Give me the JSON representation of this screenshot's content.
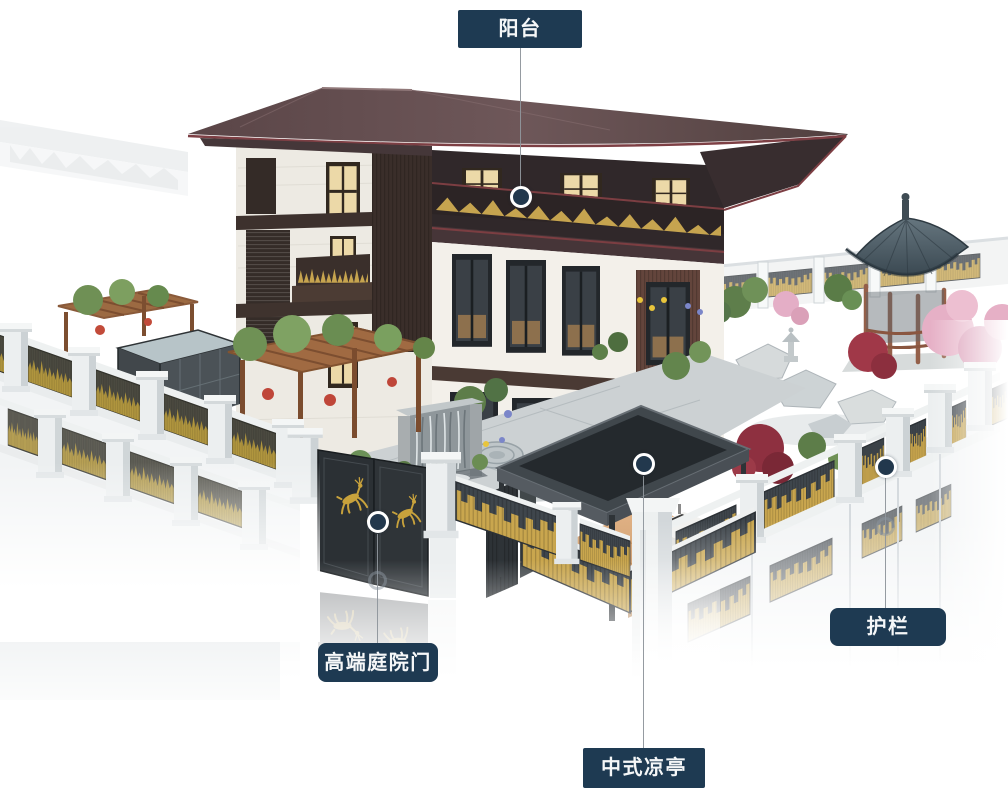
{
  "canvas": {
    "width": 1008,
    "height": 800,
    "background": "#ffffff"
  },
  "colors": {
    "label_bg": "#1e3a52",
    "label_text": "#f5f7f8",
    "callout_line": "#8f969c",
    "marker_fill": "#22384d",
    "marker_ring": "#ffffff",
    "gold_accent": "#c9a64e",
    "roof_brown": "#5e4a4d",
    "fence_white": "#eceff0"
  },
  "callouts": [
    {
      "id": "balcony",
      "label": "阳台"
    },
    {
      "id": "gate",
      "label": "高端庭院门"
    },
    {
      "id": "pavilion",
      "label": "中式凉亭"
    },
    {
      "id": "railing",
      "label": "护栏"
    }
  ]
}
